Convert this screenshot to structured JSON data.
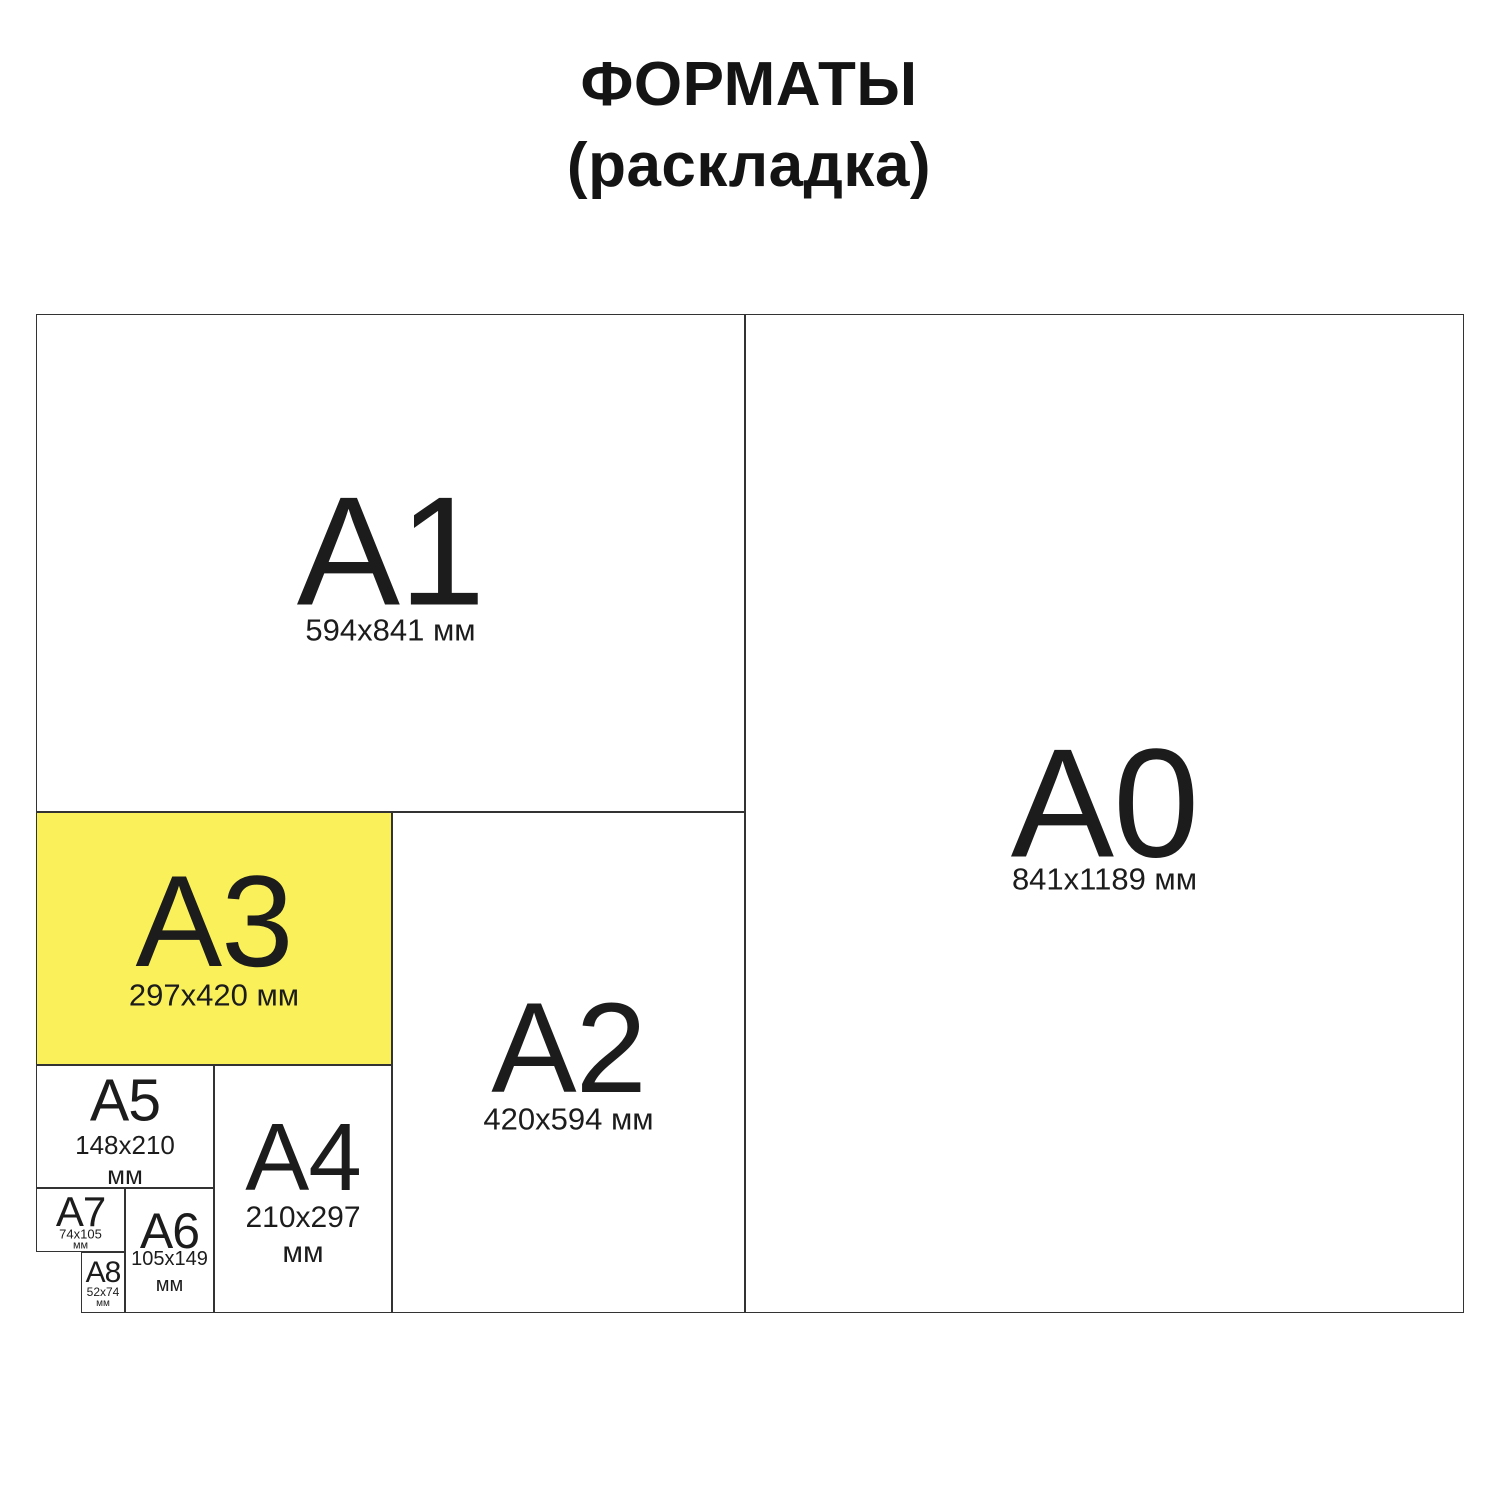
{
  "title": {
    "line1": "ФОРМАТЫ",
    "line2": "(раскладка)"
  },
  "colors": {
    "highlight": "#FAF15A",
    "line": "#333333",
    "text": "#1C1C1C",
    "background": "#FFFFFF"
  },
  "highlighted_format": "A3",
  "formats": [
    {
      "code": "A0",
      "size": "841x1189 мм"
    },
    {
      "code": "A1",
      "size": "594x841 мм"
    },
    {
      "code": "A2",
      "size": "420x594 мм"
    },
    {
      "code": "A3",
      "size": "297x420 мм",
      "highlighted": true
    },
    {
      "code": "A4",
      "size_line1": "210x297",
      "size_line2": "мм"
    },
    {
      "code": "A5",
      "size_line1": "148x210",
      "size_line2": "мм"
    },
    {
      "code": "A6",
      "size_line1": "105x149",
      "size_line2": "мм"
    },
    {
      "code": "A7",
      "size_line1": "74x105",
      "size_line2": "мм"
    },
    {
      "code": "A8",
      "size_line1": "52x74",
      "size_line2": "мм"
    }
  ]
}
